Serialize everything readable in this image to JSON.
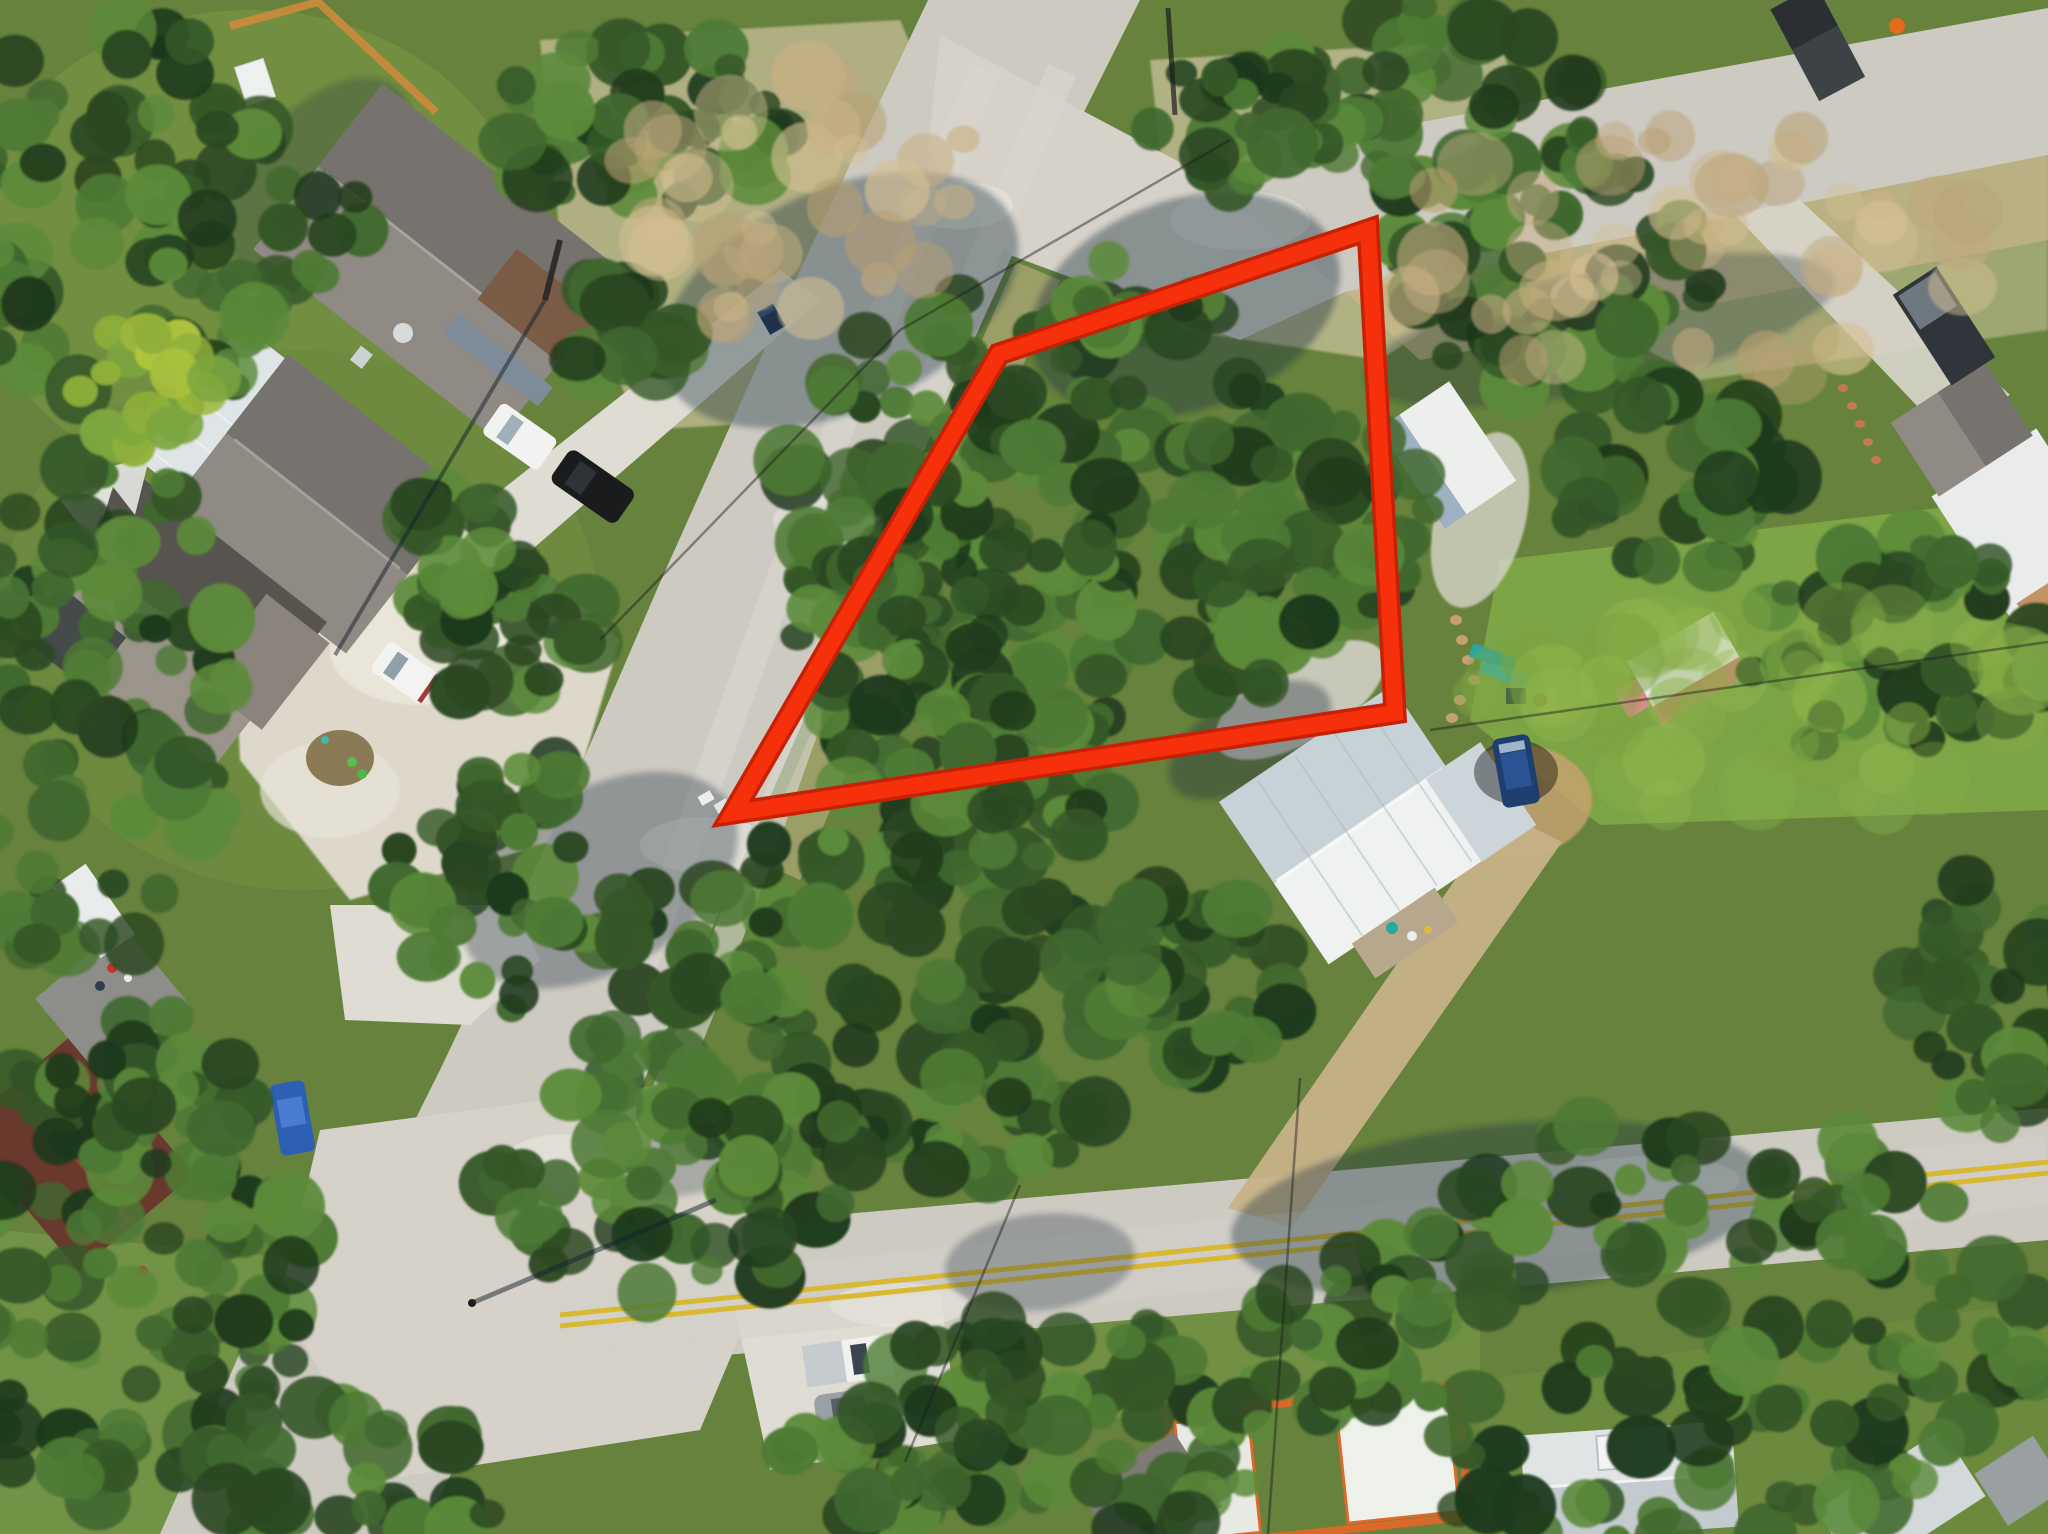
{
  "scene": {
    "type": "aerial-drone-photo",
    "subject": "wooded residential corner lot outlined in red at a road intersection",
    "lighting": "daytime sun with long tree and pole shadows"
  },
  "boundary": {
    "shape": "lot-outline-quadrilateral",
    "points": "733,813 999,354 1368,230 1395,713",
    "color": "#f5300b",
    "underlay_color": "#c62106",
    "stroke_width": 16,
    "underlay_width": 23
  },
  "palette": {
    "base_green": "#66823c",
    "lawn_bright": "#7fa746",
    "road": "#cdcac2",
    "road_light": "#d9d6ce",
    "road_patch": "#e9e7df",
    "junction": "#d6d2c9",
    "driveway": "#dfdcd3",
    "dirt": "#c7b288",
    "caliche": "#ddd8c9",
    "yellow_line": "#d9b832",
    "shadow": "#1b2d3f",
    "shingle": "#8f8a84",
    "shingle_dark": "#76726d",
    "metal_roof": "#dfe4e6",
    "metal_roof_shaded": "#c7d1d8",
    "house_brown": "#6a392d",
    "orange_frame": "#d96a2a",
    "pink_shed": "#cf7b74",
    "fence_orange": "#c98a3c",
    "tree_shades": [
      "#1f3a1c",
      "#2a4722",
      "#355728",
      "#41682f",
      "#4e7a35",
      "#5c8a3a"
    ],
    "tree_light_shades": [
      "#9db83c",
      "#aec43e",
      "#8fb03a",
      "#7ca63f"
    ],
    "grass_light_shades": [
      "#86ac49",
      "#93b84e",
      "#7da341"
    ],
    "dry_shades": [
      "#c9b183",
      "#bfa87e",
      "#d4c093",
      "#b89f72"
    ]
  },
  "seed": 20240317,
  "vegetation_clusters": [
    [
      1085,
      495,
      300,
      235,
      150,
      "t"
    ],
    [
      905,
      625,
      120,
      165,
      60,
      "t"
    ],
    [
      880,
      1010,
      300,
      190,
      120,
      "t"
    ],
    [
      690,
      1185,
      200,
      115,
      55,
      "t"
    ],
    [
      1060,
      1430,
      230,
      115,
      60,
      "t"
    ],
    [
      1660,
      1330,
      400,
      215,
      150,
      "t"
    ],
    [
      1890,
      650,
      170,
      110,
      45,
      "t"
    ],
    [
      1540,
      270,
      170,
      120,
      55,
      "t"
    ],
    [
      1430,
      95,
      170,
      95,
      45,
      "t"
    ],
    [
      640,
      120,
      150,
      95,
      45,
      "t"
    ],
    [
      150,
      210,
      220,
      200,
      85,
      "t"
    ],
    [
      90,
      705,
      150,
      270,
      75,
      "t"
    ],
    [
      130,
      1310,
      190,
      210,
      75,
      "t"
    ],
    [
      500,
      625,
      95,
      75,
      28,
      "t"
    ],
    [
      620,
      330,
      65,
      55,
      18,
      "t"
    ],
    [
      455,
      545,
      60,
      55,
      16,
      "t"
    ],
    [
      150,
      385,
      75,
      65,
      22,
      "y"
    ],
    [
      800,
      200,
      190,
      130,
      35,
      "d"
    ],
    [
      1700,
      255,
      320,
      130,
      45,
      "d"
    ],
    [
      1760,
      705,
      290,
      120,
      40,
      "g"
    ],
    [
      520,
      885,
      130,
      125,
      40,
      "t"
    ],
    [
      140,
      1105,
      130,
      95,
      35,
      "t"
    ],
    [
      350,
      1480,
      160,
      80,
      30,
      "t"
    ],
    [
      980,
      780,
      140,
      90,
      40,
      "t"
    ],
    [
      1300,
      520,
      140,
      110,
      50,
      "t"
    ],
    [
      1680,
      480,
      120,
      90,
      35,
      "t"
    ],
    [
      2000,
      1000,
      100,
      140,
      35,
      "t"
    ],
    [
      1180,
      985,
      120,
      90,
      35,
      "t"
    ],
    [
      1240,
      120,
      90,
      70,
      25,
      "t"
    ],
    [
      905,
      1465,
      120,
      60,
      25,
      "t"
    ]
  ]
}
